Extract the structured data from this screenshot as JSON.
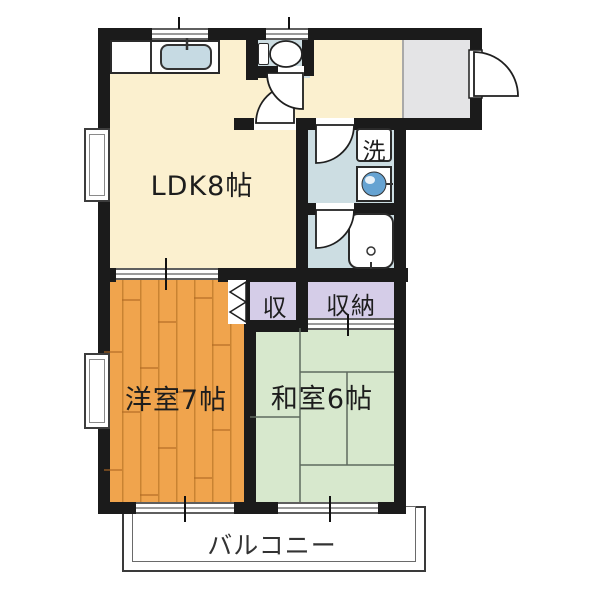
{
  "labels": {
    "ldk": "LDK8帖",
    "western_room": "洋室7帖",
    "japanese_room": "和室6帖",
    "closet": "収",
    "storage": "収納",
    "laundry": "洗",
    "balcony": "バルコニー"
  },
  "colors": {
    "wall": "#1b1b1b",
    "cream": "#fbf0cf",
    "wood": "#f0a44d",
    "wood-line": "#c98332",
    "green": "#d7e8cd",
    "lav": "#d5cde8",
    "wet": "#ccdde2",
    "entry": "#e4e4e6",
    "sink-blue": "#c6dae3",
    "basin-blue": "#66a3d2",
    "tatami-line": "#5f6b5f"
  }
}
